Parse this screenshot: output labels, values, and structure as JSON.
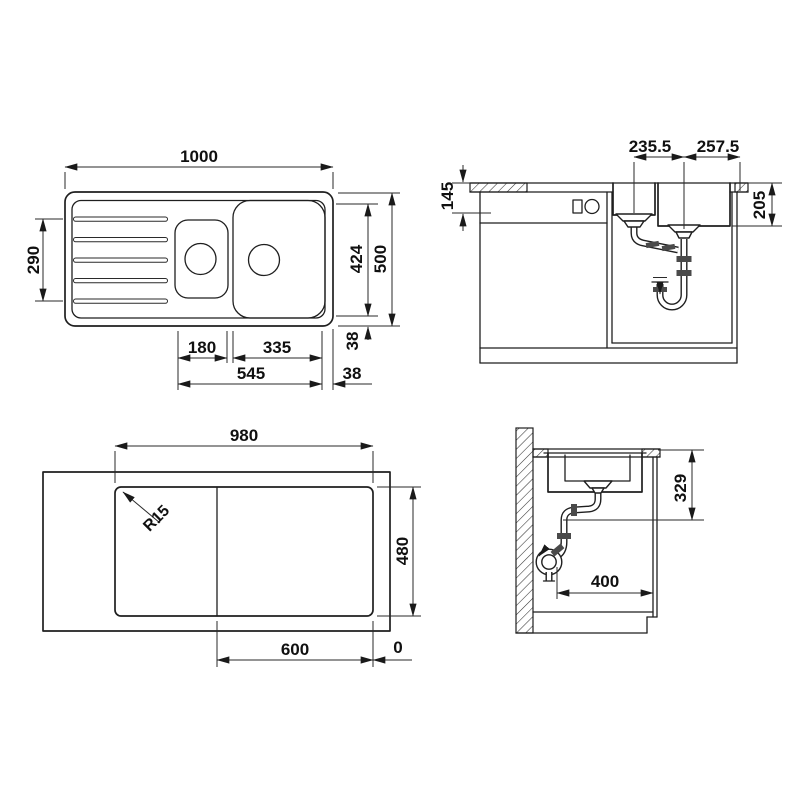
{
  "drawing": {
    "product": "Inset kitchen sink with drainer - installation drawing",
    "unit": "mm",
    "colors": {
      "line": "#1f1f1f",
      "background": "#ffffff"
    },
    "views": {
      "top": {
        "dims": {
          "overall_width": "1000",
          "drainer_grooves": "290",
          "inner_depth": "424",
          "overall_depth": "500",
          "small_bowl_width": "180",
          "large_bowl_width": "335",
          "bowls_span": "545",
          "edge_offset_vertical": "38",
          "edge_offset_horizontal": "38"
        }
      },
      "front_section": {
        "dims": {
          "drain_spacing": "235.5",
          "drain_to_edge": "257.5",
          "front_height": "145",
          "bowl_depth": "205"
        }
      },
      "underside": {
        "dims": {
          "cutout_width": "980",
          "cutout_depth": "480",
          "board_width": "600",
          "zero_reference": "0",
          "corner_radius": "R15"
        }
      },
      "side_section": {
        "dims": {
          "trap_height": "329",
          "wall_clearance": "400"
        }
      }
    }
  }
}
